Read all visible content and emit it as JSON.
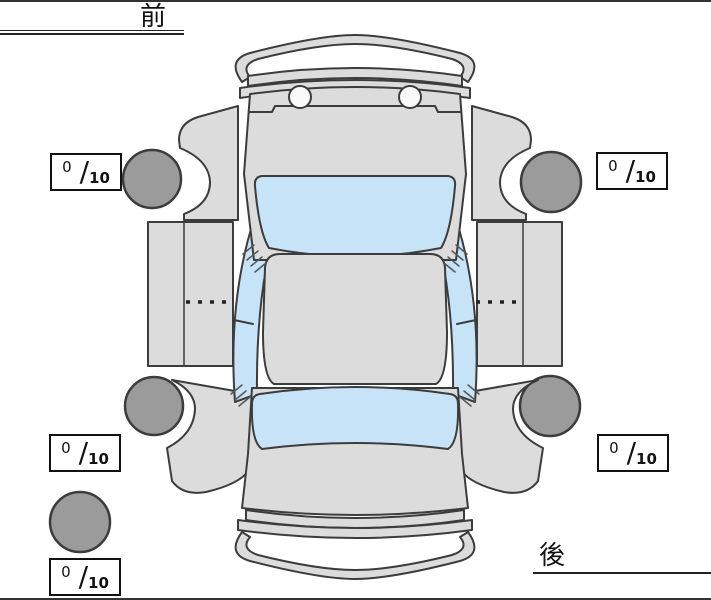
{
  "labels": {
    "front": "前",
    "rear": "後"
  },
  "score_format": {
    "separator": "/"
  },
  "tread_scores": {
    "front_left": {
      "value": "0",
      "max": "10"
    },
    "front_right": {
      "value": "0",
      "max": "10"
    },
    "rear_left": {
      "value": "0",
      "max": "10"
    },
    "rear_right": {
      "value": "0",
      "max": "10"
    },
    "spare": {
      "value": "0",
      "max": "10"
    }
  },
  "colors": {
    "background": "#ffffff",
    "body_panel": "#dcdcdc",
    "window_glass": "#c6e3f8",
    "tire": "#9b9b9b",
    "outline": "#3c3c3c",
    "frame_border": "#333333",
    "score_box_border": "#111111"
  }
}
